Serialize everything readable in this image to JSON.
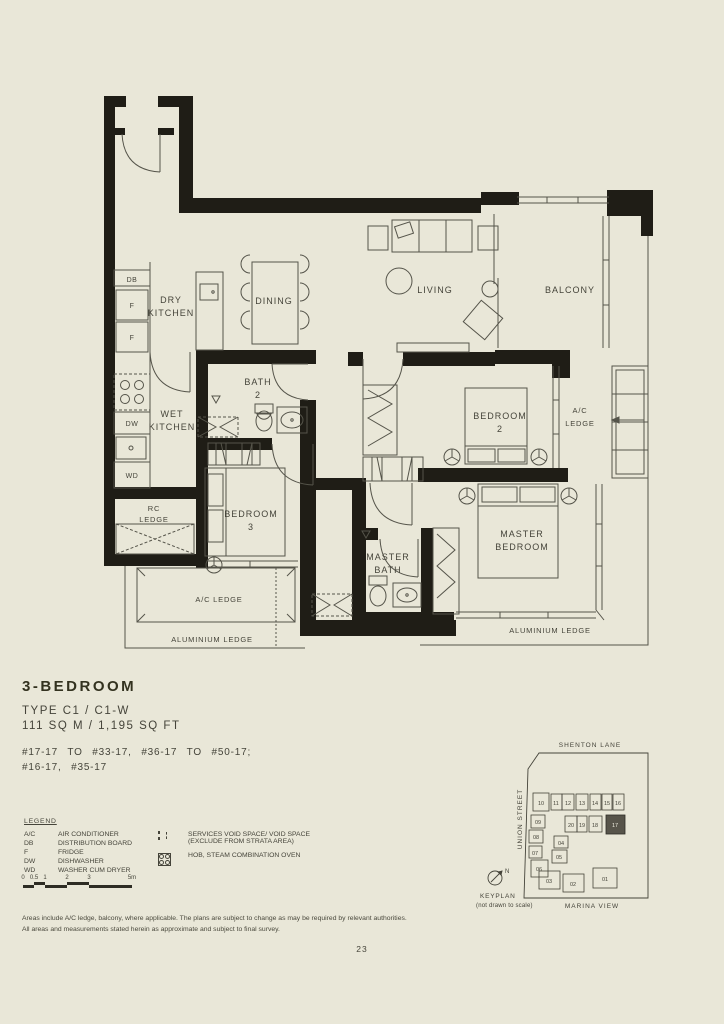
{
  "page": {
    "number": "23",
    "bg": "#e9e7d8",
    "ink": "#45443a",
    "wall": "#1f1d16",
    "highlight": "#57544a"
  },
  "title": {
    "heading": "3-BEDROOM",
    "type_line": "TYPE C1 / C1-W",
    "area_line": "111 SQ M / 1,195 SQ FT",
    "units_line1": "#17-17 TO #33-17, #36-17 TO #50-17;",
    "units_line2": "#16-17, #35-17"
  },
  "floorplan": {
    "rooms": {
      "dry_kitchen": [
        "DRY",
        "KITCHEN"
      ],
      "wet_kitchen": [
        "WET",
        "KITCHEN"
      ],
      "dining": "DINING",
      "living": "LIVING",
      "balcony": "BALCONY",
      "bath2": [
        "BATH",
        "2"
      ],
      "bedroom2": [
        "BEDROOM",
        "2"
      ],
      "bedroom3": [
        "BEDROOM",
        "3"
      ],
      "master_bedroom": [
        "MASTER",
        "BEDROOM"
      ],
      "master_bath": [
        "MASTER",
        "BATH"
      ],
      "ac_ledge_right": [
        "A/C",
        "LEDGE"
      ],
      "rc_ledge": [
        "RC",
        "LEDGE"
      ],
      "ac_ledge_bottom": "A/C LEDGE",
      "aluminium_ledge_left": "ALUMINIUM LEDGE",
      "aluminium_ledge_right": "ALUMINIUM LEDGE"
    },
    "appliances": {
      "db": "DB",
      "f1": "F",
      "f2": "F",
      "dw": "DW",
      "wd": "WD"
    }
  },
  "legend": {
    "heading": "LEGEND",
    "items": [
      {
        "abbr": "A/C",
        "label": "AIR CONDITIONER"
      },
      {
        "abbr": "DB",
        "label": "DISTRIBUTION BOARD"
      },
      {
        "abbr": "F",
        "label": "FRIDGE"
      },
      {
        "abbr": "DW",
        "label": "DISHWASHER"
      },
      {
        "abbr": "WD",
        "label": "WASHER CUM DRYER"
      }
    ],
    "symbols": [
      {
        "icon": "services-void-icon",
        "line1": "SERVICES VOID SPACE/ VOID SPACE",
        "line2": "(EXCLUDE FROM STRATA AREA)"
      },
      {
        "icon": "hob-oven-icon",
        "line1": "HOB, STEAM COMBINATION OVEN",
        "line2": ""
      }
    ]
  },
  "scalebar": {
    "labels": [
      "0",
      "0.5",
      "1",
      "2",
      "3",
      "5m"
    ]
  },
  "keyplan": {
    "title": "KEYPLAN",
    "subtitle": "(not drawn to scale)",
    "streets": {
      "top": "SHENTON LANE",
      "left": "UNION STREET",
      "bottom": "MARINA VIEW"
    },
    "compass": "N",
    "highlight_unit": "17",
    "units": [
      "10",
      "11",
      "12",
      "13",
      "14",
      "15",
      "16",
      "09",
      "08",
      "07",
      "06",
      "20",
      "19",
      "18",
      "17",
      "04",
      "05",
      "03",
      "02",
      "01"
    ]
  },
  "disclaimer": [
    "Areas include A/C ledge, balcony, where applicable. The plans are subject to change as may be required by relevant authorities.",
    "All areas and measurements stated herein as approximate and subject to final survey."
  ]
}
